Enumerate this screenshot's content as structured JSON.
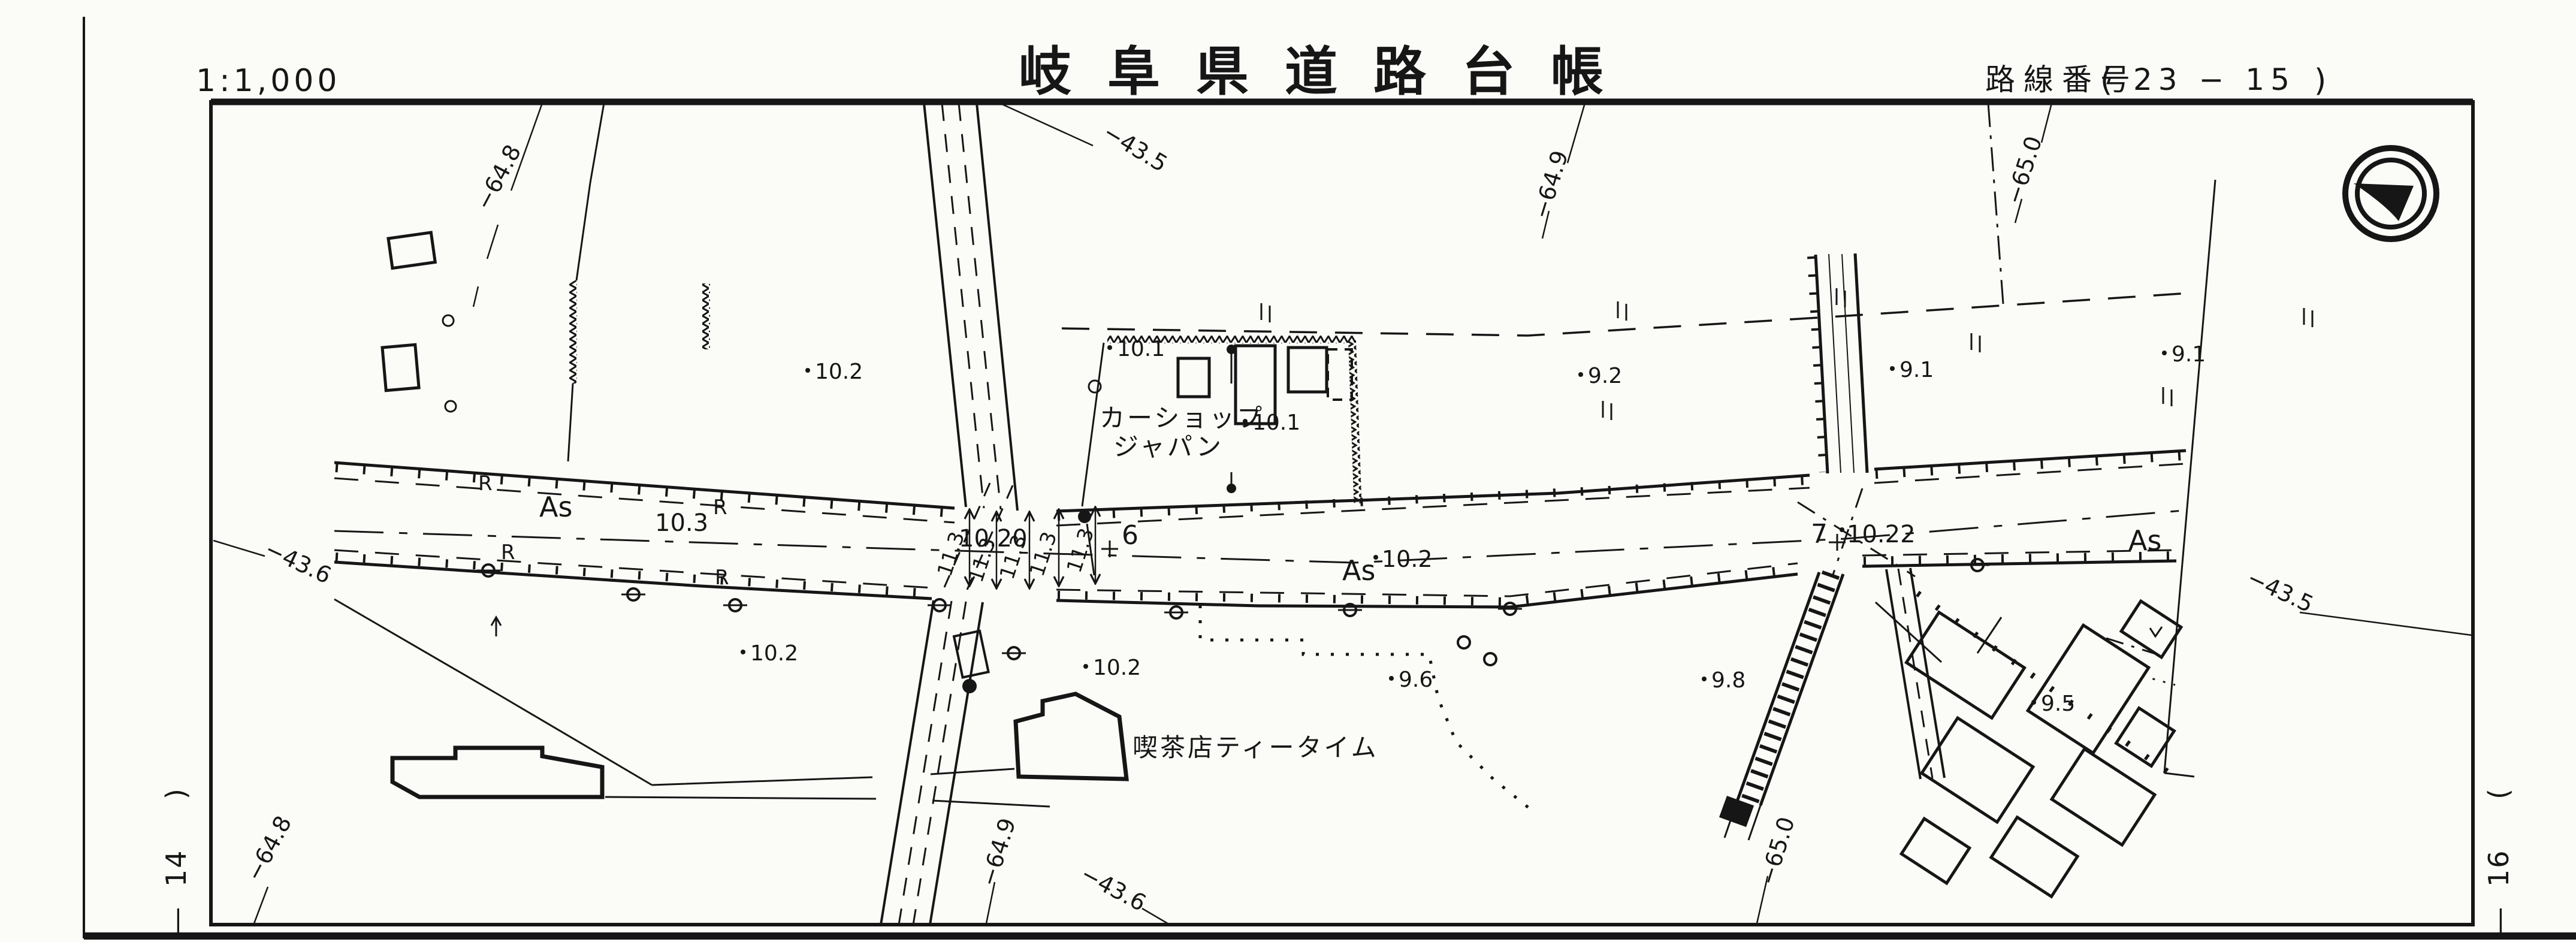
{
  "colors": {
    "ink": "#161616",
    "paper": "#fbfbf8"
  },
  "header": {
    "scale": "1:1,000",
    "title": "岐阜県道路台帳",
    "route_label": "路線番号",
    "route_open": "(",
    "route_value": "23 − 15",
    "route_close": ")"
  },
  "margins": {
    "left_dash": "―",
    "left_number": "14",
    "left_paren": ")",
    "right_dash": "―",
    "right_number": "16",
    "right_paren": "("
  },
  "grid_labels": [
    "−64.8",
    "−43.5",
    "−64.9",
    "−65.0",
    "−43.6",
    "−43.5",
    "−64.8",
    "−64.9",
    "−43.6",
    "−65.0"
  ],
  "road": {
    "surface": [
      "As",
      "As",
      "As"
    ],
    "widths": [
      "11.3",
      "11.3",
      "11.3",
      "11.3",
      "11.3"
    ],
    "stations": [
      "6",
      "7"
    ],
    "edge_marks": [
      "R",
      "R",
      "R",
      "R"
    ],
    "elevations": [
      "10.3",
      "10.20",
      "10.2",
      "10.22"
    ]
  },
  "spots": [
    "10.2",
    "10.1",
    "10.1",
    "9.2",
    "9.1",
    "9.1",
    "10.2",
    "10.2",
    "9.6",
    "9.8",
    "9.5"
  ],
  "labels": {
    "car_shop_1": "カーショップ",
    "car_shop_2": "ジャパン",
    "coffee_shop": "喫茶店ティータイム"
  }
}
